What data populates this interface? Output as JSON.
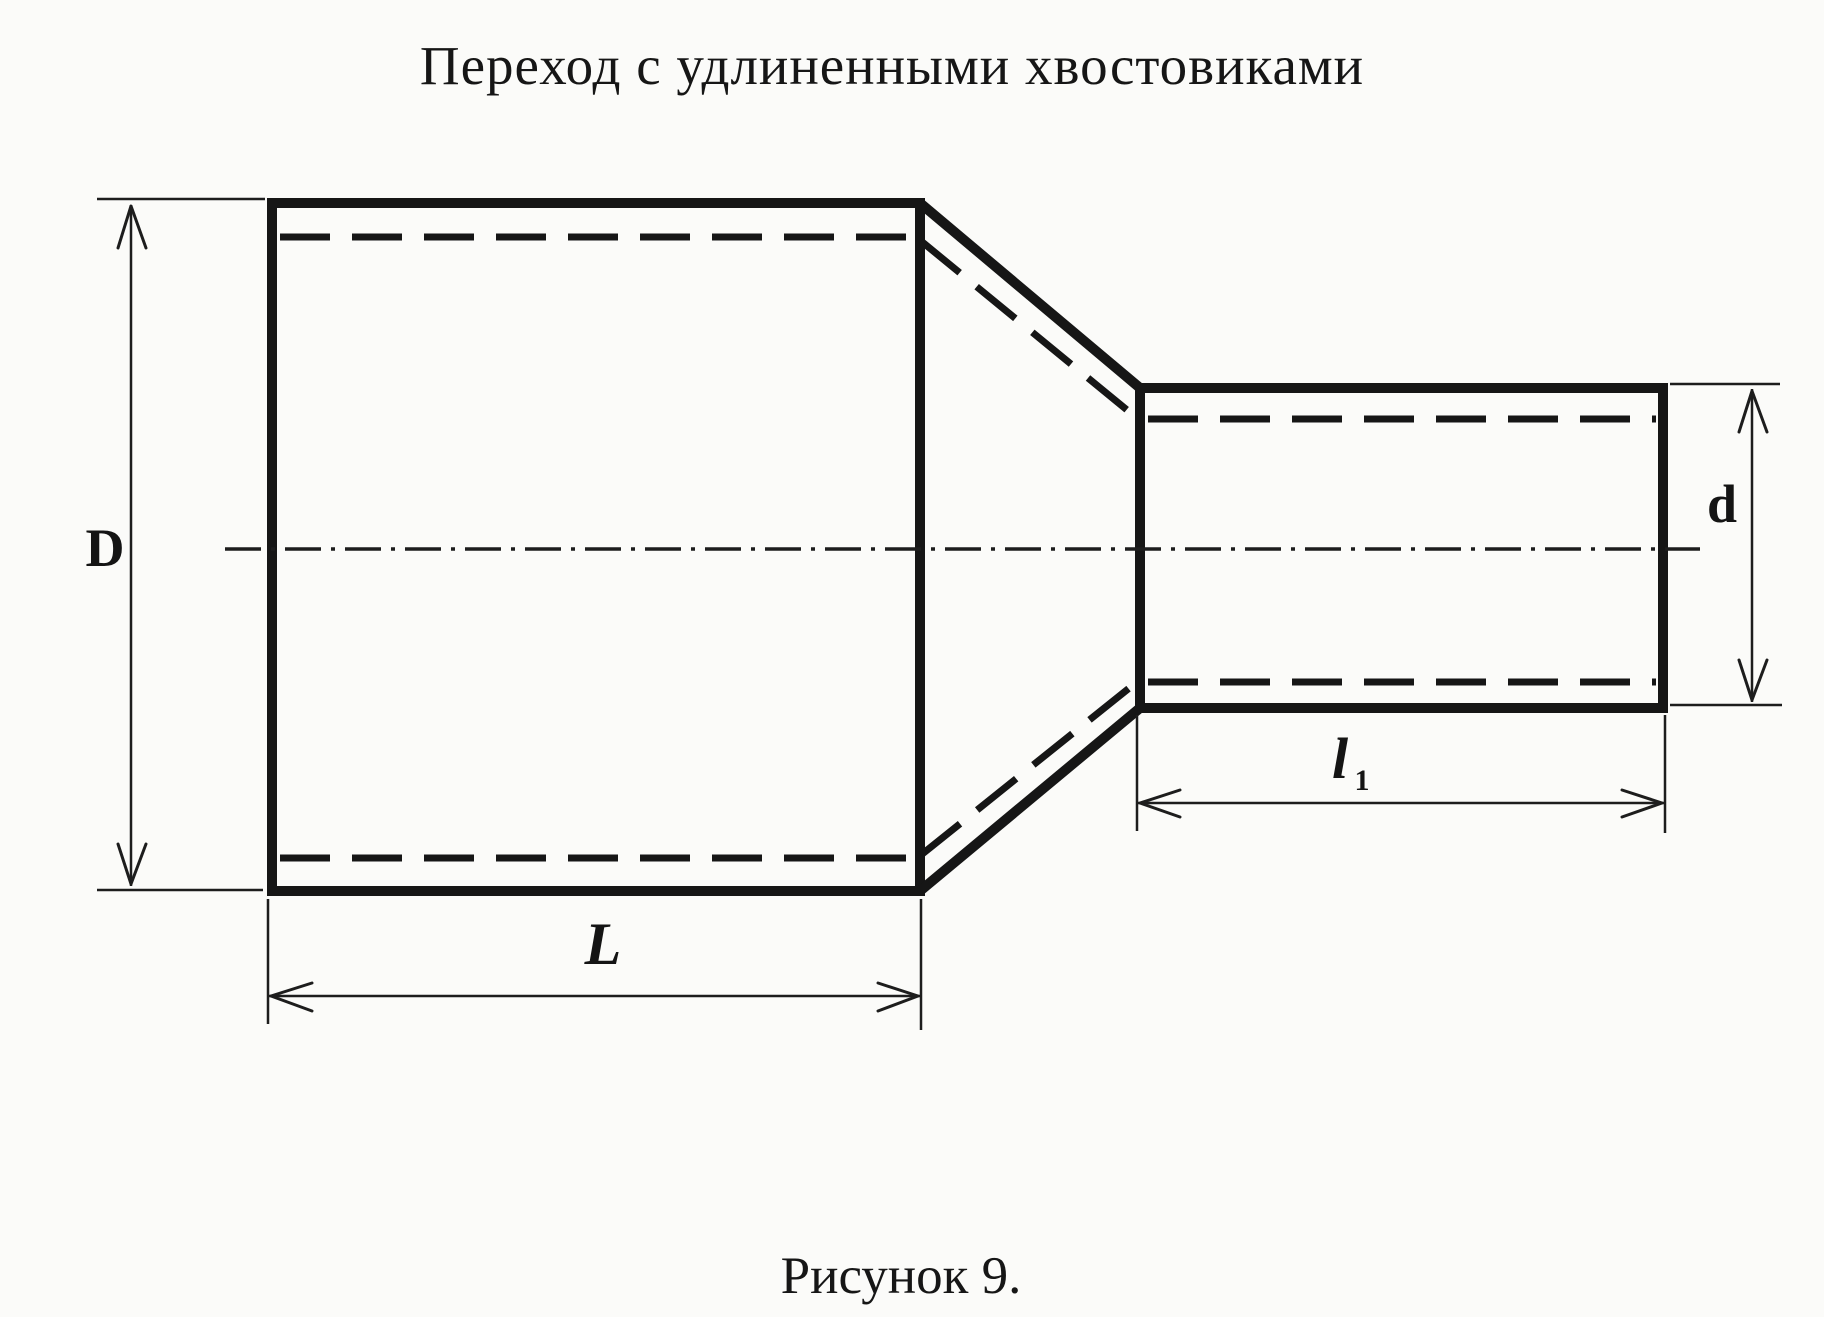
{
  "title": "Переход с удлиненными хвостовиками",
  "caption": "Рисунок 9.",
  "dimension_labels": {
    "large_diameter": "D",
    "small_diameter": "d",
    "large_length": "L",
    "small_length_base": "l",
    "small_length_subscript": "1"
  },
  "colors": {
    "ink": "#161616",
    "paper": "#fbfbf9"
  }
}
